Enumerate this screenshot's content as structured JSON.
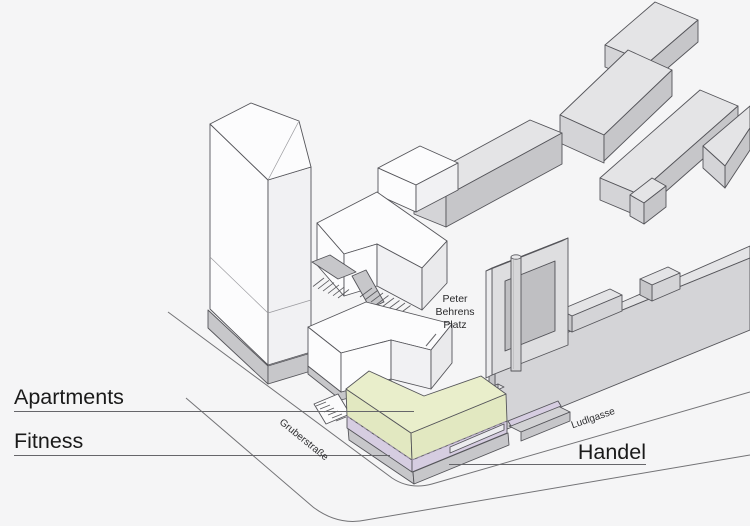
{
  "diagram_title": "Site axonometric diagram with program labels",
  "program_labels": {
    "apartments": "Apartments",
    "fitness": "Fitness",
    "handel": "Handel"
  },
  "annotations": {
    "platz_line1": "Peter",
    "platz_line2": "Behrens",
    "platz_line3": "Platz"
  },
  "streets": {
    "gruberstrasse": "Gruberstraße",
    "ludlgasse": "Ludlgasse"
  },
  "colors": {
    "background": "#f5f5f6",
    "apartments_fill": "#e9eecb",
    "apartments_side": "#e2e8c1",
    "fitness_fill": "#d6cde1",
    "plinth_gray": "#c7c7ca",
    "context_top": "#e4e4e6",
    "context_side": "#d4d4d7",
    "context_front": "#c6c6c9",
    "white_face": "#fcfcfd",
    "white_shade": "#f1f1f3",
    "outline": "#55555a",
    "street_line": "#737376",
    "label_text": "#1a1a1a"
  }
}
